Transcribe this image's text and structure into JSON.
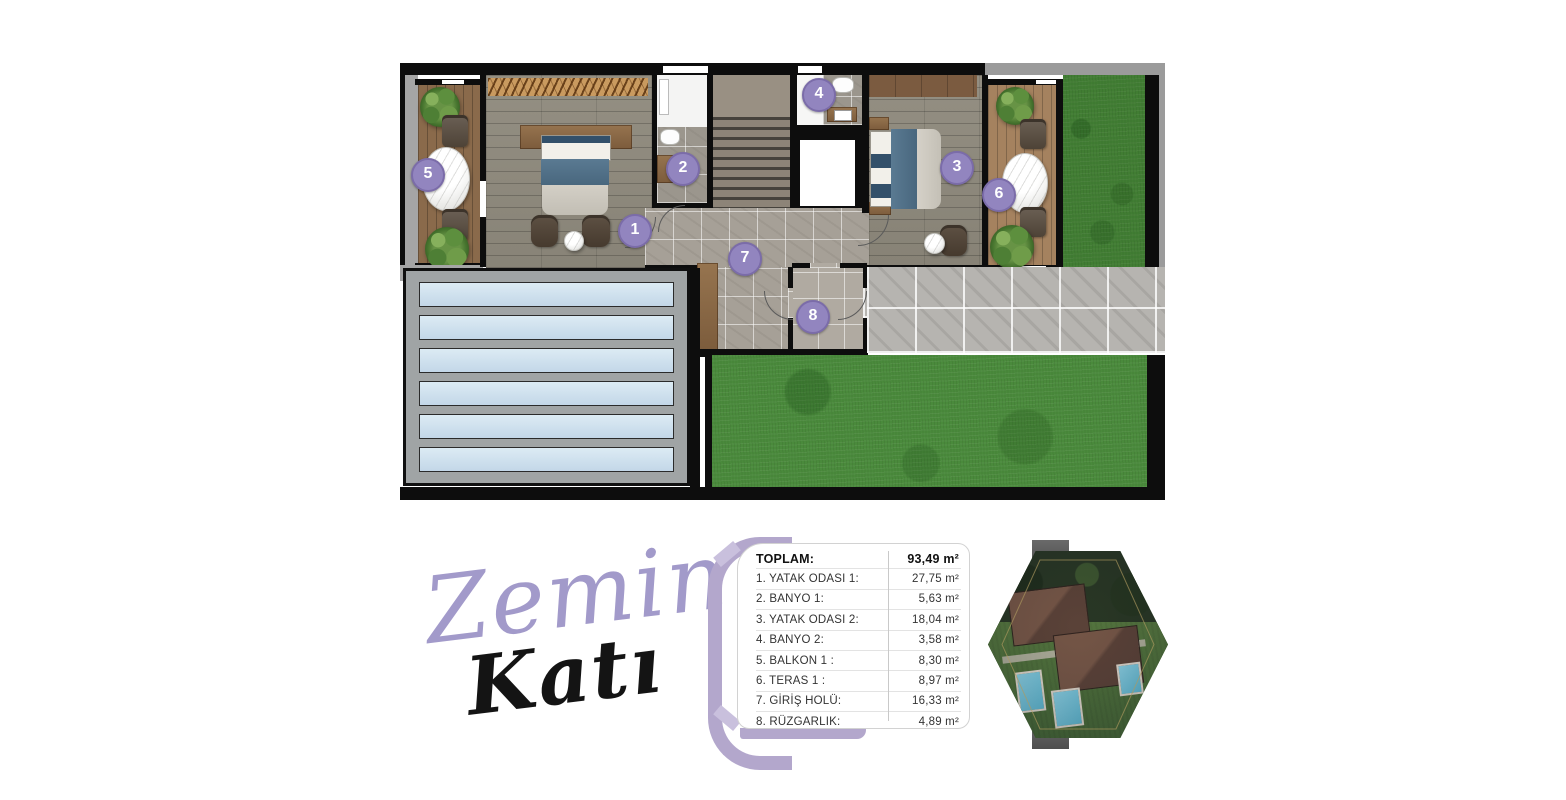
{
  "title": {
    "word1": "Zemin",
    "word2": "Katı",
    "word1_color": "#a29aca",
    "word2_color": "#141414"
  },
  "legend": {
    "rows": [
      {
        "label": "TOPLAM:",
        "value": "93,49 m²",
        "bold": true
      },
      {
        "label": "1. YATAK ODASI 1:",
        "value": "27,75 m²",
        "bold": false
      },
      {
        "label": "2. BANYO 1:",
        "value": "5,63 m²",
        "bold": false
      },
      {
        "label": "3. YATAK ODASI 2:",
        "value": "18,04 m²",
        "bold": false
      },
      {
        "label": "4. BANYO 2:",
        "value": "3,58 m²",
        "bold": false
      },
      {
        "label": "5. BALKON 1 :",
        "value": "8,30 m²",
        "bold": false
      },
      {
        "label": "6. TERAS 1 :",
        "value": "8,97 m²",
        "bold": false
      },
      {
        "label": "7. GİRİŞ HOLÜ:",
        "value": "16,33 m²",
        "bold": false
      },
      {
        "label": "8. RÜZGARLIK:",
        "value": "4,89 m²",
        "bold": false
      }
    ]
  },
  "plan": {
    "badge_fill": "#9285bf",
    "badge_border": "#7b6ca9",
    "badges": [
      {
        "num": "1",
        "x": 235,
        "y": 168
      },
      {
        "num": "2",
        "x": 283,
        "y": 106
      },
      {
        "num": "3",
        "x": 557,
        "y": 105
      },
      {
        "num": "4",
        "x": 419,
        "y": 32
      },
      {
        "num": "5",
        "x": 28,
        "y": 112
      },
      {
        "num": "6",
        "x": 599,
        "y": 132
      },
      {
        "num": "7",
        "x": 345,
        "y": 196
      },
      {
        "num": "8",
        "x": 413,
        "y": 254
      }
    ]
  },
  "accent": {
    "bracket_purple": "#b3a7cc",
    "grass_green": "#4a8a3c"
  }
}
